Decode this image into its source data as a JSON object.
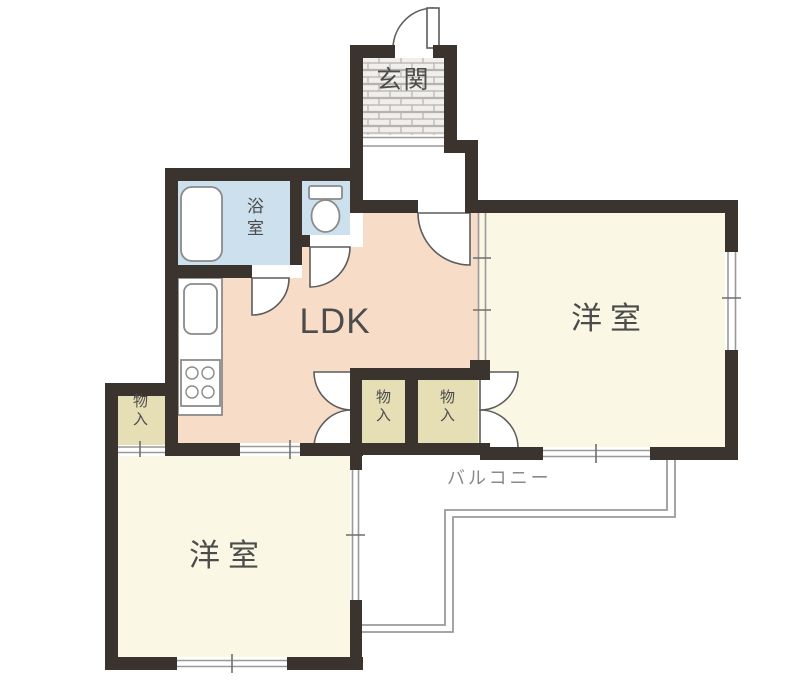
{
  "rooms": {
    "entrance": {
      "label": "玄関"
    },
    "ldk": {
      "label": "LDK"
    },
    "bathroom": {
      "label": "浴室"
    },
    "western_room_right": {
      "label": "洋室"
    },
    "western_room_lower": {
      "label": "洋室"
    },
    "storage_ldk_left": {
      "label": "物入"
    },
    "storage_ldk_right": {
      "label": "物入"
    },
    "storage_lower": {
      "label": "物入"
    },
    "balcony": {
      "label": "バルコニー"
    }
  },
  "colors": {
    "wall": "#3a332e",
    "ldk_floor": "#f7dcc7",
    "room_floor": "#fbf7e5",
    "wet_area": "#cde0ee",
    "storage": "#e6deb4",
    "entrance_tile_bg": "#f0efed",
    "balcony_rail": "#9a9a9a",
    "label_text": "#4c4c4c",
    "balcony_label_text": "#8a8a8a"
  }
}
